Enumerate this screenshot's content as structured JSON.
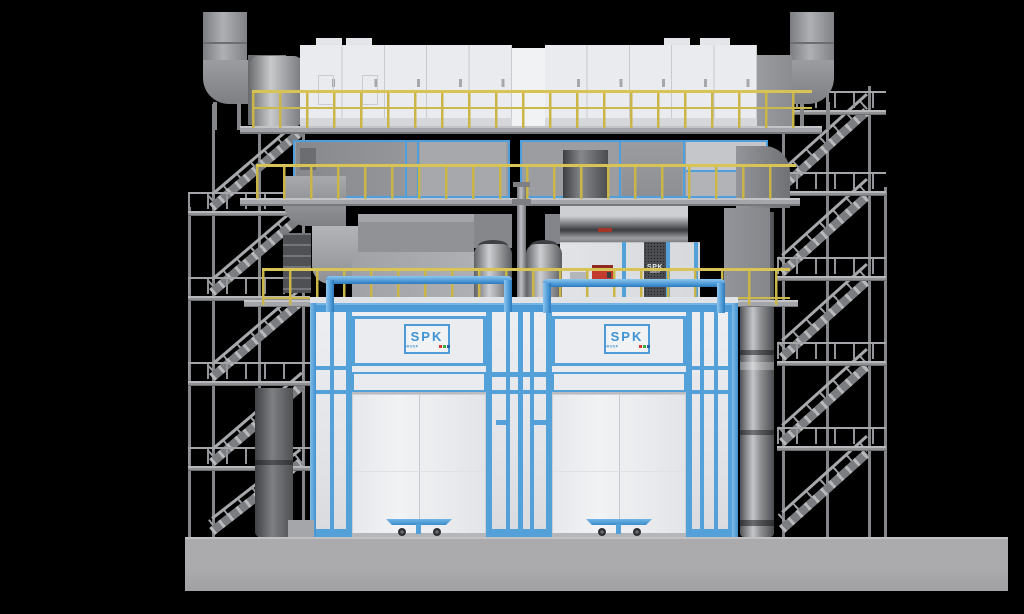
{
  "scene": {
    "background_color": "#000000"
  },
  "palette": {
    "booth_panel_white": "#e8e9ed",
    "trim_blue": "#54a0d9",
    "pipe_blue": "#4392d3",
    "duct_gray": "#97999d",
    "duct_dark_gray": "#5b5d61",
    "railing_yellow": "#cdb94b",
    "floor_gray": "#a9a9ab",
    "alarm_red": "#c23b2e",
    "logo_dot_colors": [
      "#d33a2c",
      "#3fa544",
      "#2c63a8"
    ]
  },
  "branding": {
    "left_booth_logo": {
      "text": "SPK",
      "subtext": "GROUP"
    },
    "right_booth_logo": {
      "text": "SPK",
      "subtext": "GROUP"
    },
    "cabinet_label": {
      "text": "SPK",
      "subtext": "GROUP"
    }
  }
}
